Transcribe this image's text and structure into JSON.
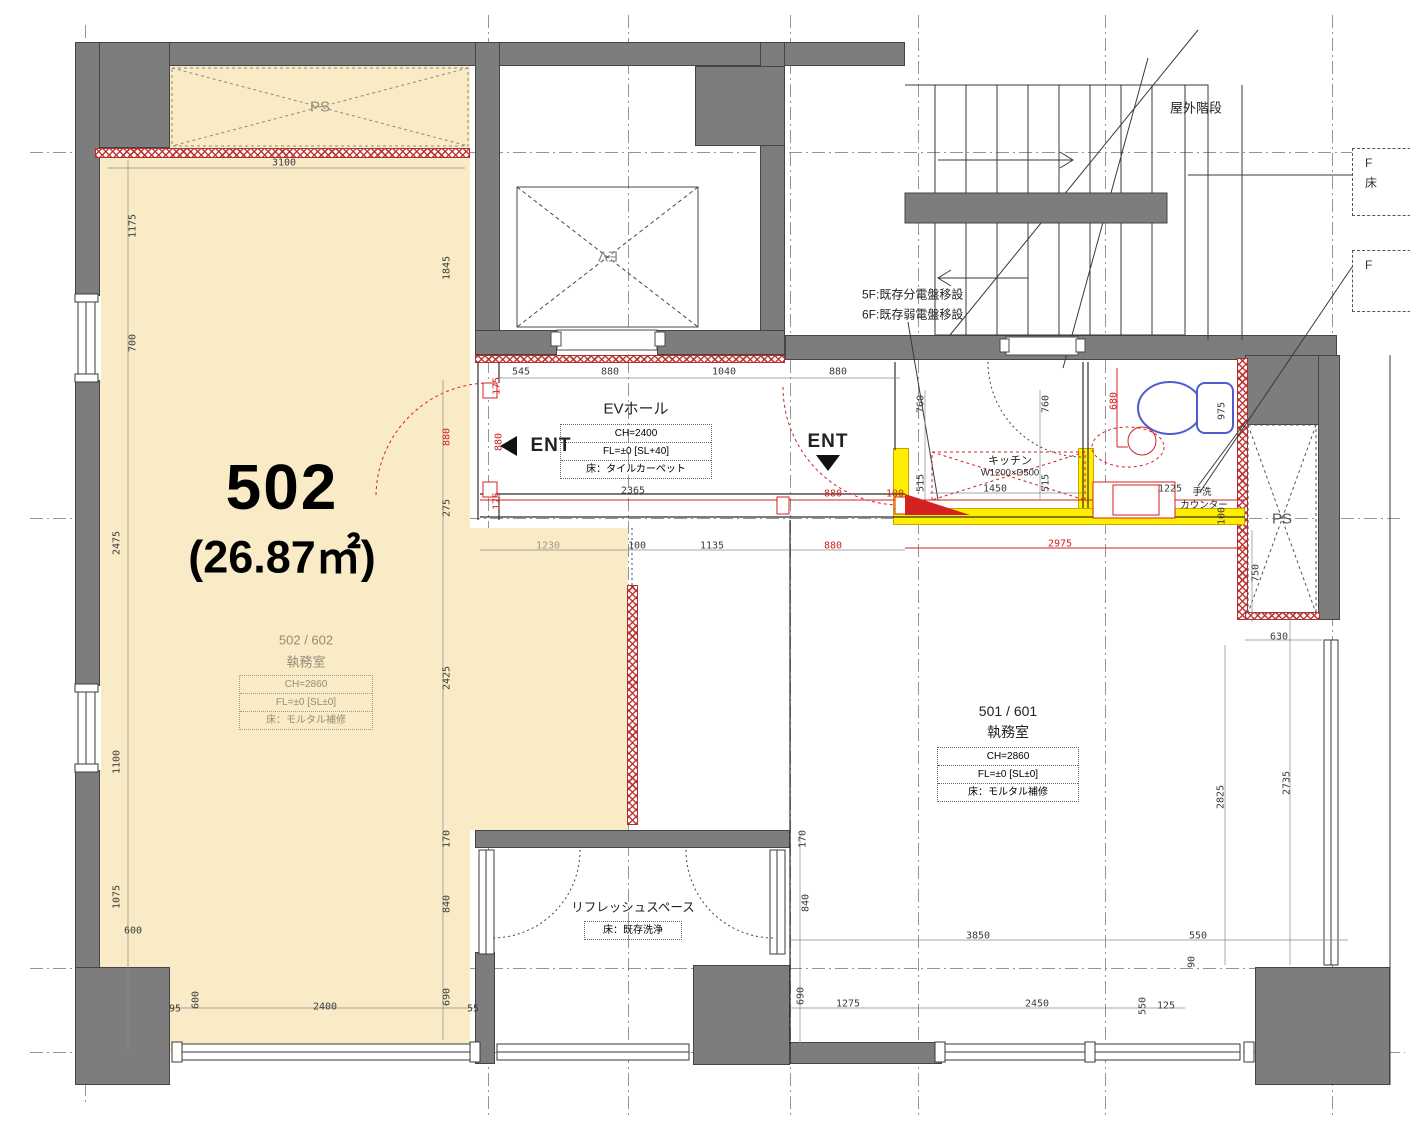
{
  "unit": {
    "number": "502",
    "area": "(26.87㎡)"
  },
  "rooms": {
    "room502": {
      "name": "502 / 602",
      "type": "執務室",
      "spec_ch": "CH=2860",
      "spec_fl": "FL=±0 [SL±0]",
      "spec_floor": "床：モルタル補修"
    },
    "room501": {
      "name": "501 / 601",
      "type": "執務室",
      "spec_ch": "CH=2860",
      "spec_fl": "FL=±0 [SL±0]",
      "spec_floor": "床：モルタル補修"
    },
    "ev_hall": {
      "name": "EVホール",
      "spec_ch": "CH=2400",
      "spec_fl": "FL=±0 [SL+40]",
      "spec_floor": "床：タイルカーペット"
    },
    "refresh": {
      "name": "リフレッシュスペース",
      "spec_floor": "床：既存洗浄"
    },
    "kitchen": {
      "name": "キッチン",
      "size": "W1200×D500"
    },
    "counter": {
      "line1": "手洗",
      "line2": "カウンター"
    }
  },
  "labels": {
    "ev": "EV",
    "ps_top": "PS",
    "ps_right": "PS",
    "ent_left": "ENT",
    "ent_right": "ENT",
    "outdoor_stairs": "屋外階段",
    "note_5f": "5F:既存分電盤移設",
    "note_6f": "6F:既存弱電盤移設",
    "fbox1_l1": "F",
    "fbox1_l2": "床",
    "fbox2_l1": "F"
  },
  "colors": {
    "highlight_beige": "#f9ebc6",
    "wall_gray": "#7d7d7d",
    "renovation_red": "#d42222",
    "highlight_yellow": "#ffee00",
    "fixture_blue": "#4d5cd0"
  },
  "dimensions": [
    {
      "t": "3100",
      "x": 284,
      "y": 163
    },
    {
      "t": "1175",
      "x": 133,
      "y": 226,
      "v": 1
    },
    {
      "t": "700",
      "x": 133,
      "y": 343,
      "v": 1
    },
    {
      "t": "1845",
      "x": 447,
      "y": 268,
      "v": 1
    },
    {
      "t": "2475",
      "x": 117,
      "y": 543,
      "v": 1
    },
    {
      "t": "1100",
      "x": 117,
      "y": 762,
      "v": 1
    },
    {
      "t": "1075",
      "x": 117,
      "y": 897,
      "v": 1
    },
    {
      "t": "600",
      "x": 133,
      "y": 931
    },
    {
      "t": "600",
      "x": 196,
      "y": 1000,
      "v": 1
    },
    {
      "t": "95",
      "x": 175,
      "y": 1009
    },
    {
      "t": "2400",
      "x": 325,
      "y": 1007
    },
    {
      "t": "55",
      "x": 473,
      "y": 1009
    },
    {
      "t": "545",
      "x": 521,
      "y": 372
    },
    {
      "t": "880",
      "x": 610,
      "y": 372
    },
    {
      "t": "1040",
      "x": 724,
      "y": 372
    },
    {
      "t": "880",
      "x": 838,
      "y": 372
    },
    {
      "t": "175",
      "x": 497,
      "y": 386,
      "v": 1,
      "c": "r"
    },
    {
      "t": "880",
      "x": 499,
      "y": 442,
      "v": 1,
      "c": "r"
    },
    {
      "t": "175",
      "x": 497,
      "y": 501,
      "v": 1,
      "c": "r"
    },
    {
      "t": "880",
      "x": 447,
      "y": 437,
      "v": 1,
      "c": "r"
    },
    {
      "t": "275",
      "x": 447,
      "y": 508,
      "v": 1
    },
    {
      "t": "2425",
      "x": 447,
      "y": 678,
      "v": 1
    },
    {
      "t": "170",
      "x": 447,
      "y": 839,
      "v": 1
    },
    {
      "t": "840",
      "x": 447,
      "y": 904,
      "v": 1
    },
    {
      "t": "690",
      "x": 447,
      "y": 997,
      "v": 1
    },
    {
      "t": "2365",
      "x": 633,
      "y": 491
    },
    {
      "t": "880",
      "x": 833,
      "y": 494,
      "c": "r"
    },
    {
      "t": "100",
      "x": 895,
      "y": 494,
      "c": "r"
    },
    {
      "t": "1230",
      "x": 548,
      "y": 546,
      "c": "g"
    },
    {
      "t": "100",
      "x": 637,
      "y": 546
    },
    {
      "t": "1135",
      "x": 712,
      "y": 546
    },
    {
      "t": "880",
      "x": 833,
      "y": 546,
      "c": "r"
    },
    {
      "t": "2975",
      "x": 1060,
      "y": 544,
      "c": "r"
    },
    {
      "t": "760",
      "x": 921,
      "y": 404,
      "v": 1
    },
    {
      "t": "760",
      "x": 1046,
      "y": 404,
      "v": 1
    },
    {
      "t": "680",
      "x": 1114,
      "y": 401,
      "v": 1,
      "c": "r"
    },
    {
      "t": "975",
      "x": 1222,
      "y": 411,
      "v": 1
    },
    {
      "t": "515",
      "x": 921,
      "y": 483,
      "v": 1
    },
    {
      "t": "1450",
      "x": 995,
      "y": 489
    },
    {
      "t": "515",
      "x": 1046,
      "y": 483,
      "v": 1
    },
    {
      "t": "1225",
      "x": 1170,
      "y": 489
    },
    {
      "t": "100",
      "x": 1222,
      "y": 516,
      "v": 1
    },
    {
      "t": "750",
      "x": 1256,
      "y": 573,
      "v": 1
    },
    {
      "t": "630",
      "x": 1279,
      "y": 637
    },
    {
      "t": "2825",
      "x": 1221,
      "y": 797,
      "v": 1
    },
    {
      "t": "2735",
      "x": 1287,
      "y": 783,
      "v": 1
    },
    {
      "t": "170",
      "x": 803,
      "y": 839,
      "v": 1
    },
    {
      "t": "840",
      "x": 806,
      "y": 903,
      "v": 1
    },
    {
      "t": "690",
      "x": 801,
      "y": 996,
      "v": 1
    },
    {
      "t": "3850",
      "x": 978,
      "y": 936
    },
    {
      "t": "550",
      "x": 1198,
      "y": 936
    },
    {
      "t": "90",
      "x": 1192,
      "y": 962,
      "v": 1
    },
    {
      "t": "1275",
      "x": 848,
      "y": 1004
    },
    {
      "t": "2450",
      "x": 1037,
      "y": 1004
    },
    {
      "t": "550",
      "x": 1143,
      "y": 1006,
      "v": 1
    },
    {
      "t": "125",
      "x": 1166,
      "y": 1006
    }
  ]
}
